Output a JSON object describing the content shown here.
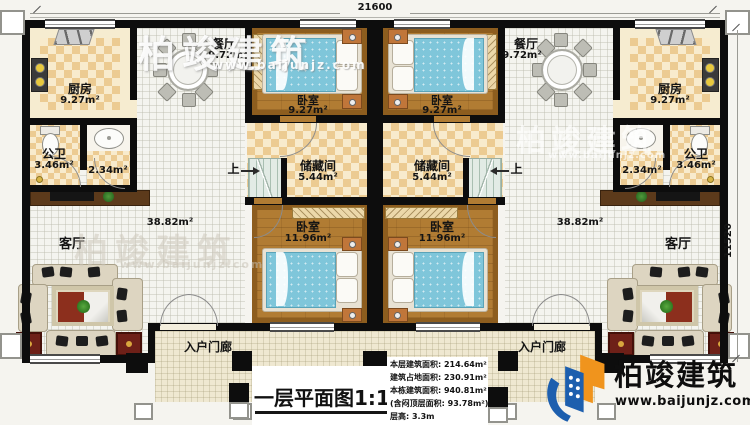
{
  "plan": {
    "title": "一层平面图1:100",
    "dim_top": "21600",
    "dim_right": "11520",
    "up_label": "上"
  },
  "rooms": {
    "kitchen": {
      "name": "厨房",
      "area": "9.27m²"
    },
    "dining": {
      "name": "餐厅",
      "area": "9.72m²"
    },
    "bedroom_top": {
      "name": "卧室",
      "area": "9.27m²"
    },
    "bedroom_bottom": {
      "name": "卧室",
      "area": "11.96m²"
    },
    "storage": {
      "name": "储藏间",
      "area": "5.44m²"
    },
    "bathroom": {
      "name": "公卫",
      "area": "3.46m²"
    },
    "washroom": {
      "area": "2.34m²"
    },
    "living": {
      "name": "客厅",
      "area": "38.82m²"
    },
    "porch": {
      "name": "入户门廊"
    }
  },
  "stats": {
    "lines": [
      "本层建筑面积: 214.64m²",
      "建筑占地面积: 230.91m²",
      "本栋建筑面积: 940.81m²",
      "(含闷顶层面积: 93.78m²)",
      "层高: 3.3m"
    ]
  },
  "brand": {
    "name": "柏竣建筑",
    "url": "www.baijunjz.com"
  }
}
